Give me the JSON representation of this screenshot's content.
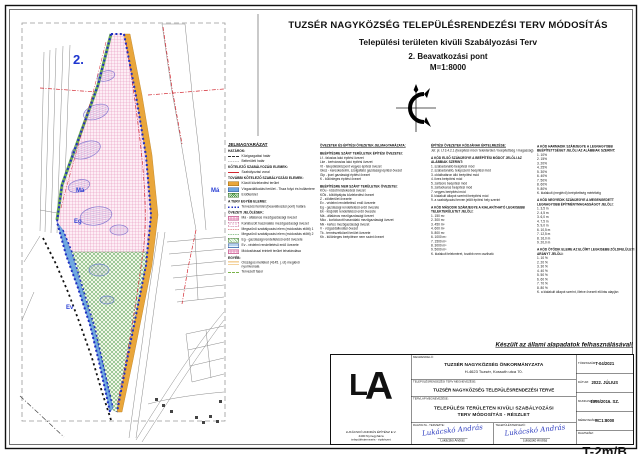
{
  "page": {
    "title1": "TUZSÉR NAGYKÖZSÉG TELEPÜLÉSRENDEZÉSI TERV MÓDOSÍTÁS",
    "title2": "Települési területen kivüli Szabályozási Terv",
    "title3": "2. Beavatkozási pont",
    "title4": "M=1:8000",
    "note": "Készült az állami alapadatok felhasználásával!"
  },
  "map": {
    "labels": {
      "area": "2.",
      "ma1": "Má",
      "ma2": "Má",
      "eg": "Eg",
      "ev": "Ev"
    },
    "colors": {
      "planning_boundary": "#1f2ec2",
      "road_area": "#e9a63b",
      "water": "#6fa7e0",
      "forest_hatch": "#4a9a4a",
      "agricultural_hatch": "#e591bb",
      "regulation_line": "#d22730",
      "area_label": "#1d35cf"
    }
  },
  "legend": {
    "title": "JELMAGYARÁZAT",
    "items": [
      {
        "c": "hdr",
        "t": "HATÁROK:"
      },
      {
        "sw": "sw-dashA",
        "t": "Közigazgatási határ"
      },
      {
        "sw": "sw-dashB",
        "t": "Belterületi határ"
      },
      {
        "c": "hdr",
        "t": "KÖTELEZŐ SZABÁLYOZÁSI ELEMEK:"
      },
      {
        "sw": "sw-red",
        "t": "Szabályozási vonal"
      },
      {
        "c": "hdr",
        "t": "TOVÁBBI KÖTELEZŐ SZABÁLYOZÁSI ELEMEK:"
      },
      {
        "sw": "sw-orange",
        "t": "Közúti közlekedési terület"
      },
      {
        "sw": "sw-blue",
        "t": "Vízgazdálkodási terület - Tisza folyó és hullámtere"
      },
      {
        "sw": "sw-greenh",
        "t": "Erdőterület"
      },
      {
        "c": "hdr",
        "t": "A TERV EGYÉB ELEMEI:"
      },
      {
        "sw": "sw-bluedot",
        "t": "Tervezési terület (beavatkozási pont) határa"
      },
      {
        "c": "hdr",
        "t": "ÖVEZETI JELÖLÉSEK:"
      },
      {
        "sw": "sw-pinkh",
        "t": "Má - általános mezőgazdasági övezet"
      },
      {
        "sw": "sw-pinkd",
        "t": "Korlátozott használatú mezőgazdasági övezet"
      },
      {
        "sw": "sw-reddash",
        "t": "Megszűnő szabályozási elem (módosítás előtti) 1"
      },
      {
        "sw": "sw-greendash",
        "t": "Megszűnő szabályozási elem (módosítás előtti) 2"
      },
      {
        "sw": "sw-hatchE",
        "t": "Eg - gazdasági rendeltetésű erdő övezete"
      },
      {
        "sw": "sw-hatchV",
        "t": "Ev - védelmi rendeltetésű erdő övezete"
      },
      {
        "sw": "sw-pinkh",
        "t": "Módosítással érintett terület lehatárolása"
      },
      {
        "c": "hdr",
        "t": "EGYÉB:"
      },
      {
        "sw": "sw-orangeline",
        "t": "Országos mellékút (4145. j. út) meglévő nyomvonala"
      },
      {
        "sw": "sw-greend2",
        "t": "Tervezett fasor"
      }
    ]
  },
  "notes": {
    "col1": [
      {
        "c": "h",
        "t": "ÖVEZETEK ÉS ÉPÍTÉSI ÖVEZETEK JELMAGYARÁZATA:"
      },
      {
        "c": "b",
        "t": ""
      },
      {
        "c": "s",
        "t": "BEÉPÍTÉSRE SZÁNT TERÜLETEK ÉPÍTÉSI ÖVEZETEI:"
      },
      {
        "c": "l",
        "t": "Lf - falusias lakó építési övezet"
      },
      {
        "c": "l",
        "t": "Lke - kertvárosias lakó építési övezet"
      },
      {
        "c": "l",
        "t": "Vt - településközpont vegyes építési övezet"
      },
      {
        "c": "l",
        "t": "Gksz - kereskedelmi, szolgáltató gazdasági építési övezet"
      },
      {
        "c": "l",
        "t": "Gip - ipari gazdasági építési övezet"
      },
      {
        "c": "l",
        "t": "K - különleges építési övezet"
      },
      {
        "c": "b",
        "t": ""
      },
      {
        "c": "s",
        "t": "BEÉPÍTÉSRE NEM SZÁNT TERÜLETEK ÖVEZETEI:"
      },
      {
        "c": "l",
        "t": "KÖu - közúti közlekedési övezet"
      },
      {
        "c": "l",
        "t": "KÖk - kötöttpályás közlekedési övezet"
      },
      {
        "c": "l",
        "t": "Z - zöldterület övezete"
      },
      {
        "c": "l",
        "t": "Ev - védelmi rendeltetésű erdő övezete"
      },
      {
        "c": "l",
        "t": "Eg - gazdasági rendeltetésű erdő övezete"
      },
      {
        "c": "l",
        "t": "Ek - közjóléti rendeltetésű erdő övezete"
      },
      {
        "c": "l",
        "t": "Má - általános mezőgazdasági övezet"
      },
      {
        "c": "l",
        "t": "Mko - korlátozott használatú mezőgazdasági övezet"
      },
      {
        "c": "l",
        "t": "Mk - kertes mezőgazdasági övezet"
      },
      {
        "c": "l",
        "t": "V - vízgazdálkodási övezet"
      },
      {
        "c": "l",
        "t": "Tk - természetközeli terület övezete"
      },
      {
        "c": "l",
        "t": "Kb - különleges beépítésre nem szánt övezet"
      }
    ],
    "col2": [
      {
        "c": "h",
        "t": "ÉPÍTÉSI ÖVEZETEK KÓDJÁNAK ÉRTELMEZÉSE:"
      },
      {
        "c": "l",
        "t": "Jel: pl. Lf 3.4.2.1 (beépítési mód / telekterület / beépítettség / magasság)"
      },
      {
        "c": "b",
        "t": ""
      },
      {
        "c": "s",
        "t": "A KÓD ELSŐ SZÁMJEGYE A BEÉPÍTÉSI MÓDOT JELÖLI AZ ALÁBBIAK SZERINT:"
      },
      {
        "c": "l",
        "t": "1. szabadonálló beépítési mód"
      },
      {
        "c": "l",
        "t": "2. szabadonálló, telepszerű beépítési mód"
      },
      {
        "c": "l",
        "t": "3. oldalhatáron álló beépítési mód"
      },
      {
        "c": "l",
        "t": "4. ikres beépítési mód"
      },
      {
        "c": "l",
        "t": "5. zártsorú beépítési mód"
      },
      {
        "c": "l",
        "t": "6. zártudvaros beépítési mód"
      },
      {
        "c": "l",
        "t": "7. vegyes beépítési mód"
      },
      {
        "c": "l",
        "t": "8. kialakult állapot szerinti beépítési mód"
      },
      {
        "c": "l",
        "t": "9. a szabályozási terven jelölt építési hely szerint"
      },
      {
        "c": "b",
        "t": ""
      },
      {
        "c": "s",
        "t": "A KÓD MÁSODIK SZÁMJEGYE A KIALAKÍTHATÓ LEGKISEBB TELEKTERÜLETET JELÖLI:"
      },
      {
        "c": "l",
        "t": "1. 150 m²"
      },
      {
        "c": "l",
        "t": "2. 300 m²"
      },
      {
        "c": "l",
        "t": "3. 450 m²"
      },
      {
        "c": "l",
        "t": "4. 600 m²"
      },
      {
        "c": "l",
        "t": "5. 800 m²"
      },
      {
        "c": "l",
        "t": "6. 1000 m²"
      },
      {
        "c": "l",
        "t": "7. 1500 m²"
      },
      {
        "c": "l",
        "t": "8. 3000 m²"
      },
      {
        "c": "l",
        "t": "9. 5000 m²"
      },
      {
        "c": "l",
        "t": "K. kialakult telekméret, tovább nem osztható"
      }
    ],
    "col3": [
      {
        "c": "s",
        "t": "A KÓD HARMADIK SZÁMJEGYE A LEGNAGYOBB BEÉPÍTETTSÉGET JELÖLI AZ ALÁBBIAK SZERINT:"
      },
      {
        "c": "l",
        "t": "1. 10%"
      },
      {
        "c": "l",
        "t": "2. 15%"
      },
      {
        "c": "l",
        "t": "3. 20%"
      },
      {
        "c": "l",
        "t": "4. 25%"
      },
      {
        "c": "l",
        "t": "5. 30%"
      },
      {
        "c": "l",
        "t": "6. 40%"
      },
      {
        "c": "l",
        "t": "7. 50%"
      },
      {
        "c": "l",
        "t": "8. 60%"
      },
      {
        "c": "l",
        "t": "9. 80%"
      },
      {
        "c": "l",
        "t": "K. kialakult (meglévő) beépítettség mértékéig"
      },
      {
        "c": "b",
        "t": ""
      },
      {
        "c": "s",
        "t": "A KÓD NEGYEDIK SZÁMJEGYE A MEGENGEDETT LEGNAGYOBB ÉPÍTMÉNYMAGASSÁGOT JELÖLI:"
      },
      {
        "c": "l",
        "t": "1. 3,5 m"
      },
      {
        "c": "l",
        "t": "2. 4,5 m"
      },
      {
        "c": "l",
        "t": "3. 6,0 m"
      },
      {
        "c": "l",
        "t": "4. 7,5 m"
      },
      {
        "c": "l",
        "t": "5. 9,0 m"
      },
      {
        "c": "l",
        "t": "6. 10,5 m"
      },
      {
        "c": "l",
        "t": "7. 12,5 m"
      },
      {
        "c": "l",
        "t": "8. 16,0 m"
      },
      {
        "c": "l",
        "t": "9. 20,0 m"
      },
      {
        "c": "b",
        "t": ""
      },
      {
        "c": "s",
        "t": "A KÓD ÖTÖDIK ELEME AZ ELŐÍRT LEGKISEBB ZÖLDFELÜLETI ARÁNYT JELÖLI:"
      },
      {
        "c": "l",
        "t": "1. 10 %"
      },
      {
        "c": "l",
        "t": "2. 20 %"
      },
      {
        "c": "l",
        "t": "3. 30 %"
      },
      {
        "c": "l",
        "t": "4. 40 %"
      },
      {
        "c": "l",
        "t": "5. 50 %"
      },
      {
        "c": "l",
        "t": "6. 60 %"
      },
      {
        "c": "l",
        "t": "7. 70 %"
      },
      {
        "c": "l",
        "t": "8. 80 %"
      },
      {
        "c": "l",
        "t": "K. a kialakult állapot szerint, illetve övezeti előírás alapján"
      }
    ]
  },
  "stamp": {
    "logo_big_l": "L",
    "logo_big_a": "A",
    "logo_lines": [
      "LUKÁCSKÓ ANDRÁS ÉPÍTÉSZ E.V.",
      "4400 Nyíregyháza",
      "településtervezés - építészet"
    ],
    "client_label": "MEGRENDELŐ:",
    "client_name": "TUZSÉR NAGYKÖZSÉG ÖNKORMÁNYZATA",
    "client_address": "H-4623 Tuzsér, Kossuth utca 70.",
    "plan_label": "TELEPÜLÉSRENDEZÉSI TERV MEGNEVEZÉSE:",
    "plan_name": "TUZSÉR NAGYKÖZSÉG TELEPÜLÉSRENDEZÉSI TERVE",
    "sheet_label": "TERVLAP MEGNEVEZÉSE:",
    "sheet_name1": "TELEPÜLÉSI TERÜLETEN KIVÜLI SZABÁLYOZÁSI",
    "sheet_name2": "TERV MÓDOSÍTÁS - RÉSZLET",
    "drawn_label": "RAJZOLTA - TERVEZTE:",
    "drawn_name": "Lukácskó András",
    "drawn_sig": "Lukácskó András",
    "designer_label": "TELEPÜLÉSTERVEZŐ:",
    "designer_name": "Lukácskó András",
    "designer_sig": "Lukácskó András",
    "meta": [
      {
        "label": "TÖRZSSZÁM:",
        "value": "T-04/2021"
      },
      {
        "label": "DÁTUM:",
        "value": "2022. JÚLIUS"
      },
      {
        "label": "MUNKASZÁM:",
        "value": "1395/2016. SZ."
      },
      {
        "label": "MÉRETARÁNY:",
        "value": "M=1:8000"
      }
    ],
    "drawing_no_label": "RAJZSZÁM:",
    "drawing_no": "T-2m/B"
  }
}
